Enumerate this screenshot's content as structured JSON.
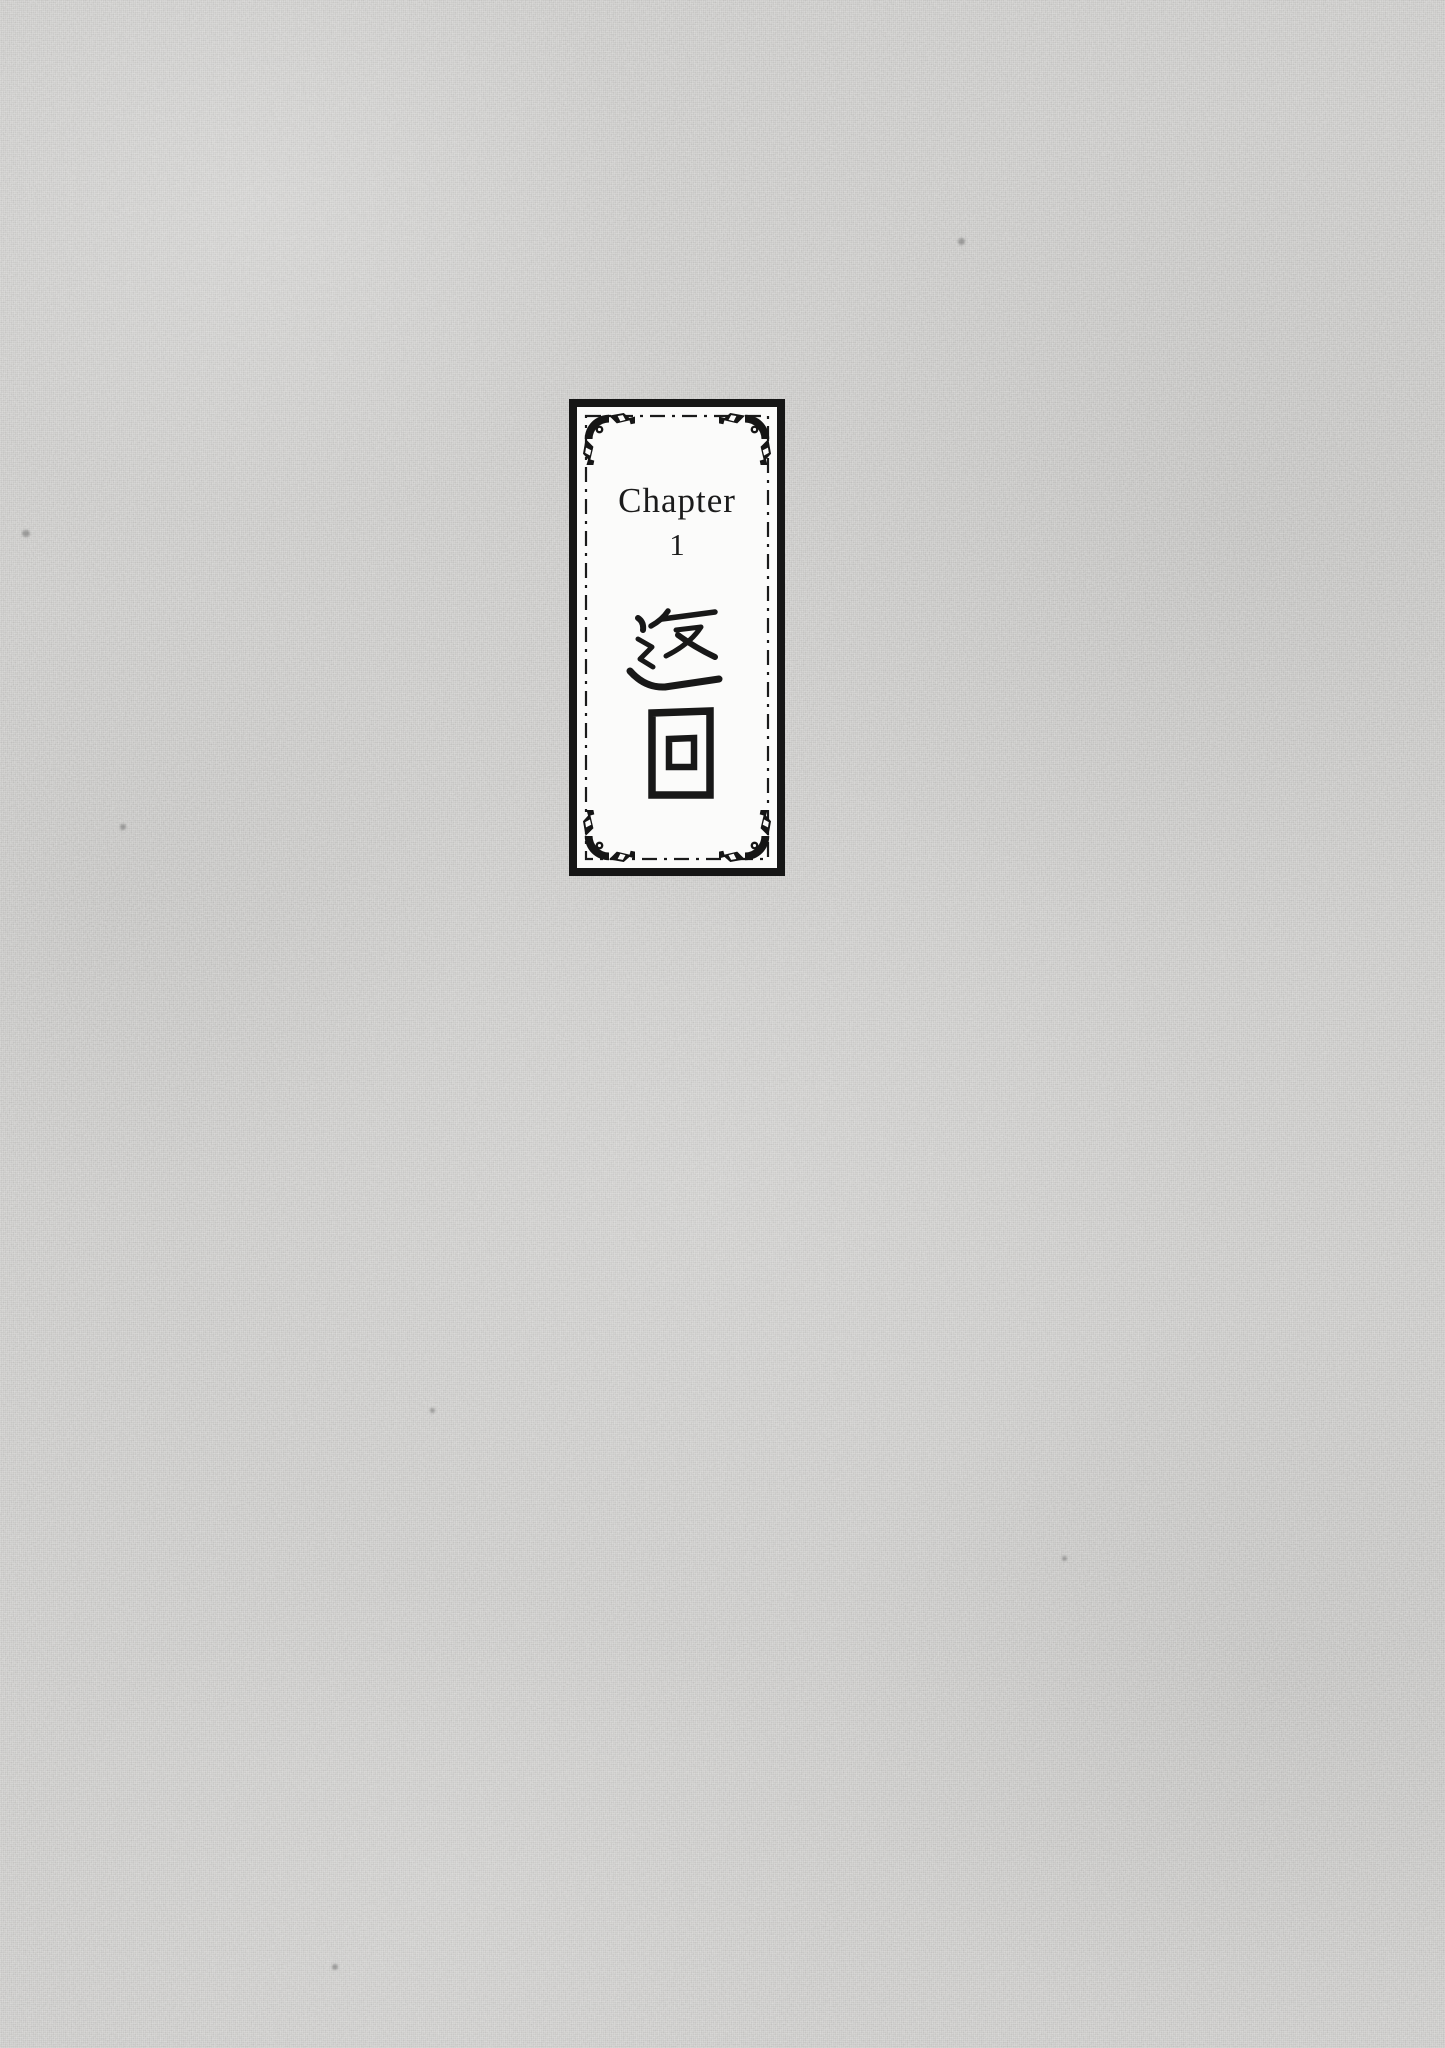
{
  "page": {
    "background_color": "#c9c8c6",
    "texture": "woven-canvas"
  },
  "chapter_plate": {
    "label": "Chapter",
    "number": "1",
    "title_cjk": "返回",
    "ink_color": "#1b1b1b",
    "plate_background": "#fbfbfa",
    "border_color": "#161616"
  }
}
